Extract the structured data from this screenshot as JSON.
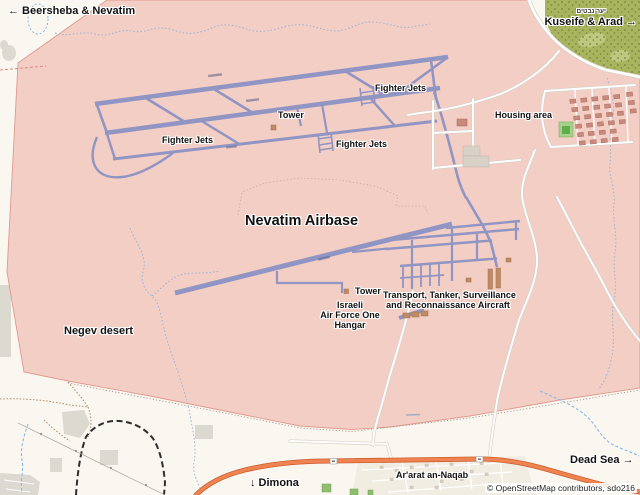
{
  "labels": {
    "beersheba": "← Beersheba & Nevatim",
    "kuseife": "Kuseife & Arad →",
    "forest_hebrew": "יער נבטים",
    "fighter_jets_ne": "Fighter Jets",
    "fighter_jets_west": "Fighter Jets",
    "fighter_jets_center": "Fighter Jets",
    "tower_north": "Tower",
    "housing_area": "Housing area",
    "base_title": "Nevatim Airbase",
    "negev_desert": "Negev desert",
    "tower_south": "Tower",
    "hangar_line1": "Israeli",
    "hangar_line2": "Air Force One",
    "hangar_line3": "Hangar",
    "transport_line1": "Transport, Tanker, Surveillance",
    "transport_line2": "and Reconnaissance Aircraft",
    "dimona": "↓ Dimona",
    "ararat": "Ar'arat an-Naqab",
    "dead_sea": "Dead Sea →",
    "attribution": "© OpenStreetMap contributors, sdo216"
  },
  "colors": {
    "desert_bg": "#faf7f0",
    "base_area": "#f3cec5",
    "base_border": "#e09a8f",
    "runway": "#9195c3",
    "forest": "#a9b45f",
    "forest_dot": "#76823c",
    "forest_light": "#c2cc86",
    "road_fill": "#ffffff",
    "road_casing": "#d6d0c6",
    "highway": "#f08352",
    "highway_casing": "#c95f2e",
    "rail": "#2e2e2e",
    "stream": "#9fb4cf",
    "stream_bright": "#86b7e4",
    "track": "#b08968",
    "gray_patch": "#dcd9d1",
    "building_gray": "#d8d1c7",
    "building_red": "#c9897c",
    "building_brown": "#c08a66",
    "field_green": "#5fae4a",
    "label": "#111111"
  }
}
